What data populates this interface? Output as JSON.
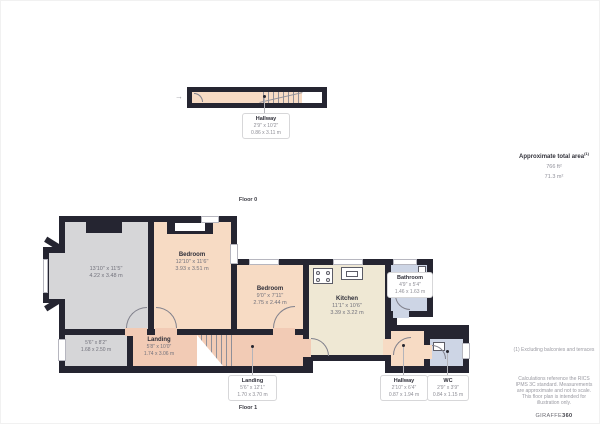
{
  "floor0": {
    "label": "Floor 0",
    "hallway": {
      "name": "Hallway",
      "imperial": "2'9\" x 10'2\"",
      "metric": "0.86 x 3.11 m"
    }
  },
  "floor1": {
    "label": "Floor 1",
    "reception": {
      "imperial": "13'10\" x 11'5\"",
      "metric": "4.22 x 3.48 m"
    },
    "bedroom1": {
      "name": "Bedroom",
      "imperial": "12'10\" x 11'6\"",
      "metric": "3.93 x 3.51 m"
    },
    "bedroom2": {
      "name": "Bedroom",
      "imperial": "9'0\" x 7'11\"",
      "metric": "2.75 x 2.44 m"
    },
    "kitchen": {
      "name": "Kitchen",
      "imperial": "11'1\" x 10'6\"",
      "metric": "3.39 x 3.22 m"
    },
    "bathroom": {
      "name": "Bathroom",
      "imperial": "4'9\" x 5'4\"",
      "metric": "1.46 x 1.63 m"
    },
    "store": {
      "imperial": "5'6\" x 8'2\"",
      "metric": "1.68 x 2.50 m"
    },
    "landing_upper": {
      "name": "Landing",
      "imperial": "5'8\" x 10'0\"",
      "metric": "1.74 x 3.06 m"
    },
    "landing_lower": {
      "name": "Landing",
      "imperial": "5'6\" x 12'1\"",
      "metric": "1.70 x 3.70 m"
    },
    "hallway": {
      "name": "Hallway",
      "imperial": "2'10\" x 6'4\"",
      "metric": "0.87 x 1.94 m"
    },
    "wc": {
      "name": "WC",
      "imperial": "2'9\" x 3'9\"",
      "metric": "0.84 x 1.15 m"
    }
  },
  "sidebar": {
    "total_area_label": "Approximate total area",
    "total_area_footnote_marker": "(1)",
    "area_imperial": "766 ft²",
    "area_metric": "71.3 m²",
    "footnote": "(1) Excluding balconies and terraces",
    "disclaimer": "Calculations reference the RICS IPMS 3C standard. Measurements are approximate and not to scale. This floor plan is intended for illustration only.",
    "brand_name": "GIRAFFE",
    "brand_suffix": "360"
  },
  "icons": {
    "entry_arrow": "→"
  },
  "colors": {
    "wall": "#252531",
    "room_peach": "#f7dbc4",
    "room_peach_dark": "#f2cbb5",
    "room_gray": "#d6d6d8",
    "room_cream": "#efe8d4",
    "room_blue": "#cdd5e5"
  }
}
